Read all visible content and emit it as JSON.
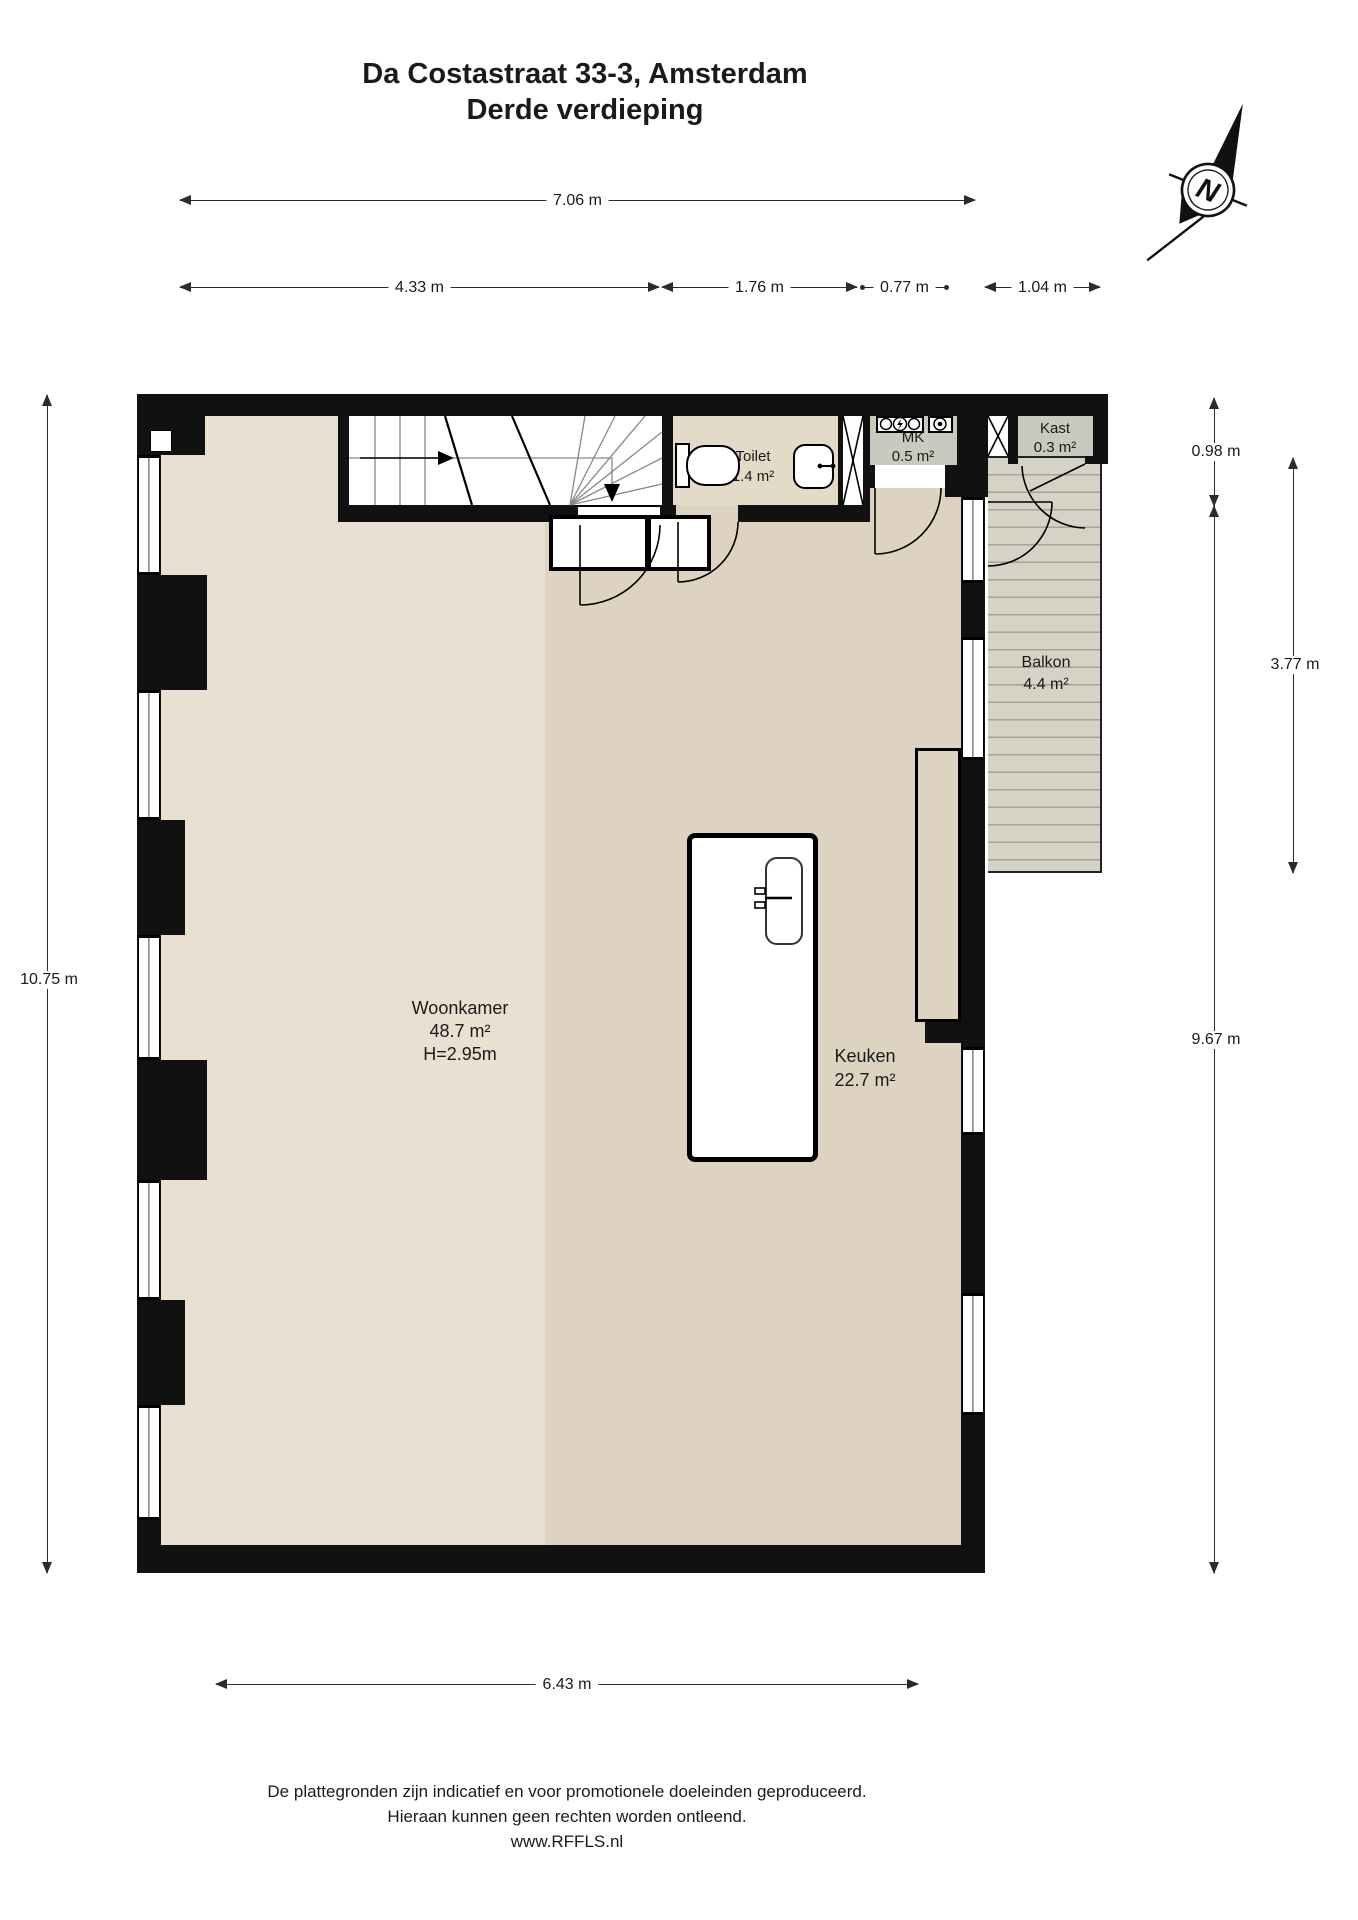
{
  "title": {
    "line1": "Da Costastraat 33-3, Amsterdam",
    "line2": "Derde verdieping"
  },
  "compass": {
    "letter": "N"
  },
  "dimensions": {
    "total_width": "7.06 m",
    "width_living": "4.33 m",
    "width_toilet": "1.76 m",
    "width_mk": "0.77 m",
    "width_balcony": "1.04 m",
    "left_height": "10.75 m",
    "right_top": "0.98 m",
    "balcony_height": "3.77 m",
    "right_main": "9.67 m",
    "bottom_width": "6.43 m"
  },
  "rooms": {
    "woonkamer": {
      "name": "Woonkamer",
      "area": "48.7 m²",
      "height": "H=2.95m"
    },
    "keuken": {
      "name": "Keuken",
      "area": "22.7 m²"
    },
    "toilet": {
      "name": "Toilet",
      "area": "1.4 m²"
    },
    "mk": {
      "name": "MK",
      "area": "0.5 m²"
    },
    "kast": {
      "name": "Kast",
      "area": "0.3 m²"
    },
    "balkon": {
      "name": "Balkon",
      "area": "4.4 m²"
    }
  },
  "footer": {
    "line1": "De plattegronden zijn indicatief en voor promotionele doeleinden geproduceerd.",
    "line2": "Hieraan kunnen geen rechten worden ontleend.",
    "line3": "www.RFFLS.nl"
  },
  "colors": {
    "wall": "#111111",
    "woonkamer": "#e9e0d1",
    "keuken": "#ded3c1",
    "toiletf": "#e4dac8",
    "closet": "#c8cabf",
    "deck": "#d5d3c6",
    "deckline": "#a5a396",
    "dim": "#2b2b2b"
  }
}
